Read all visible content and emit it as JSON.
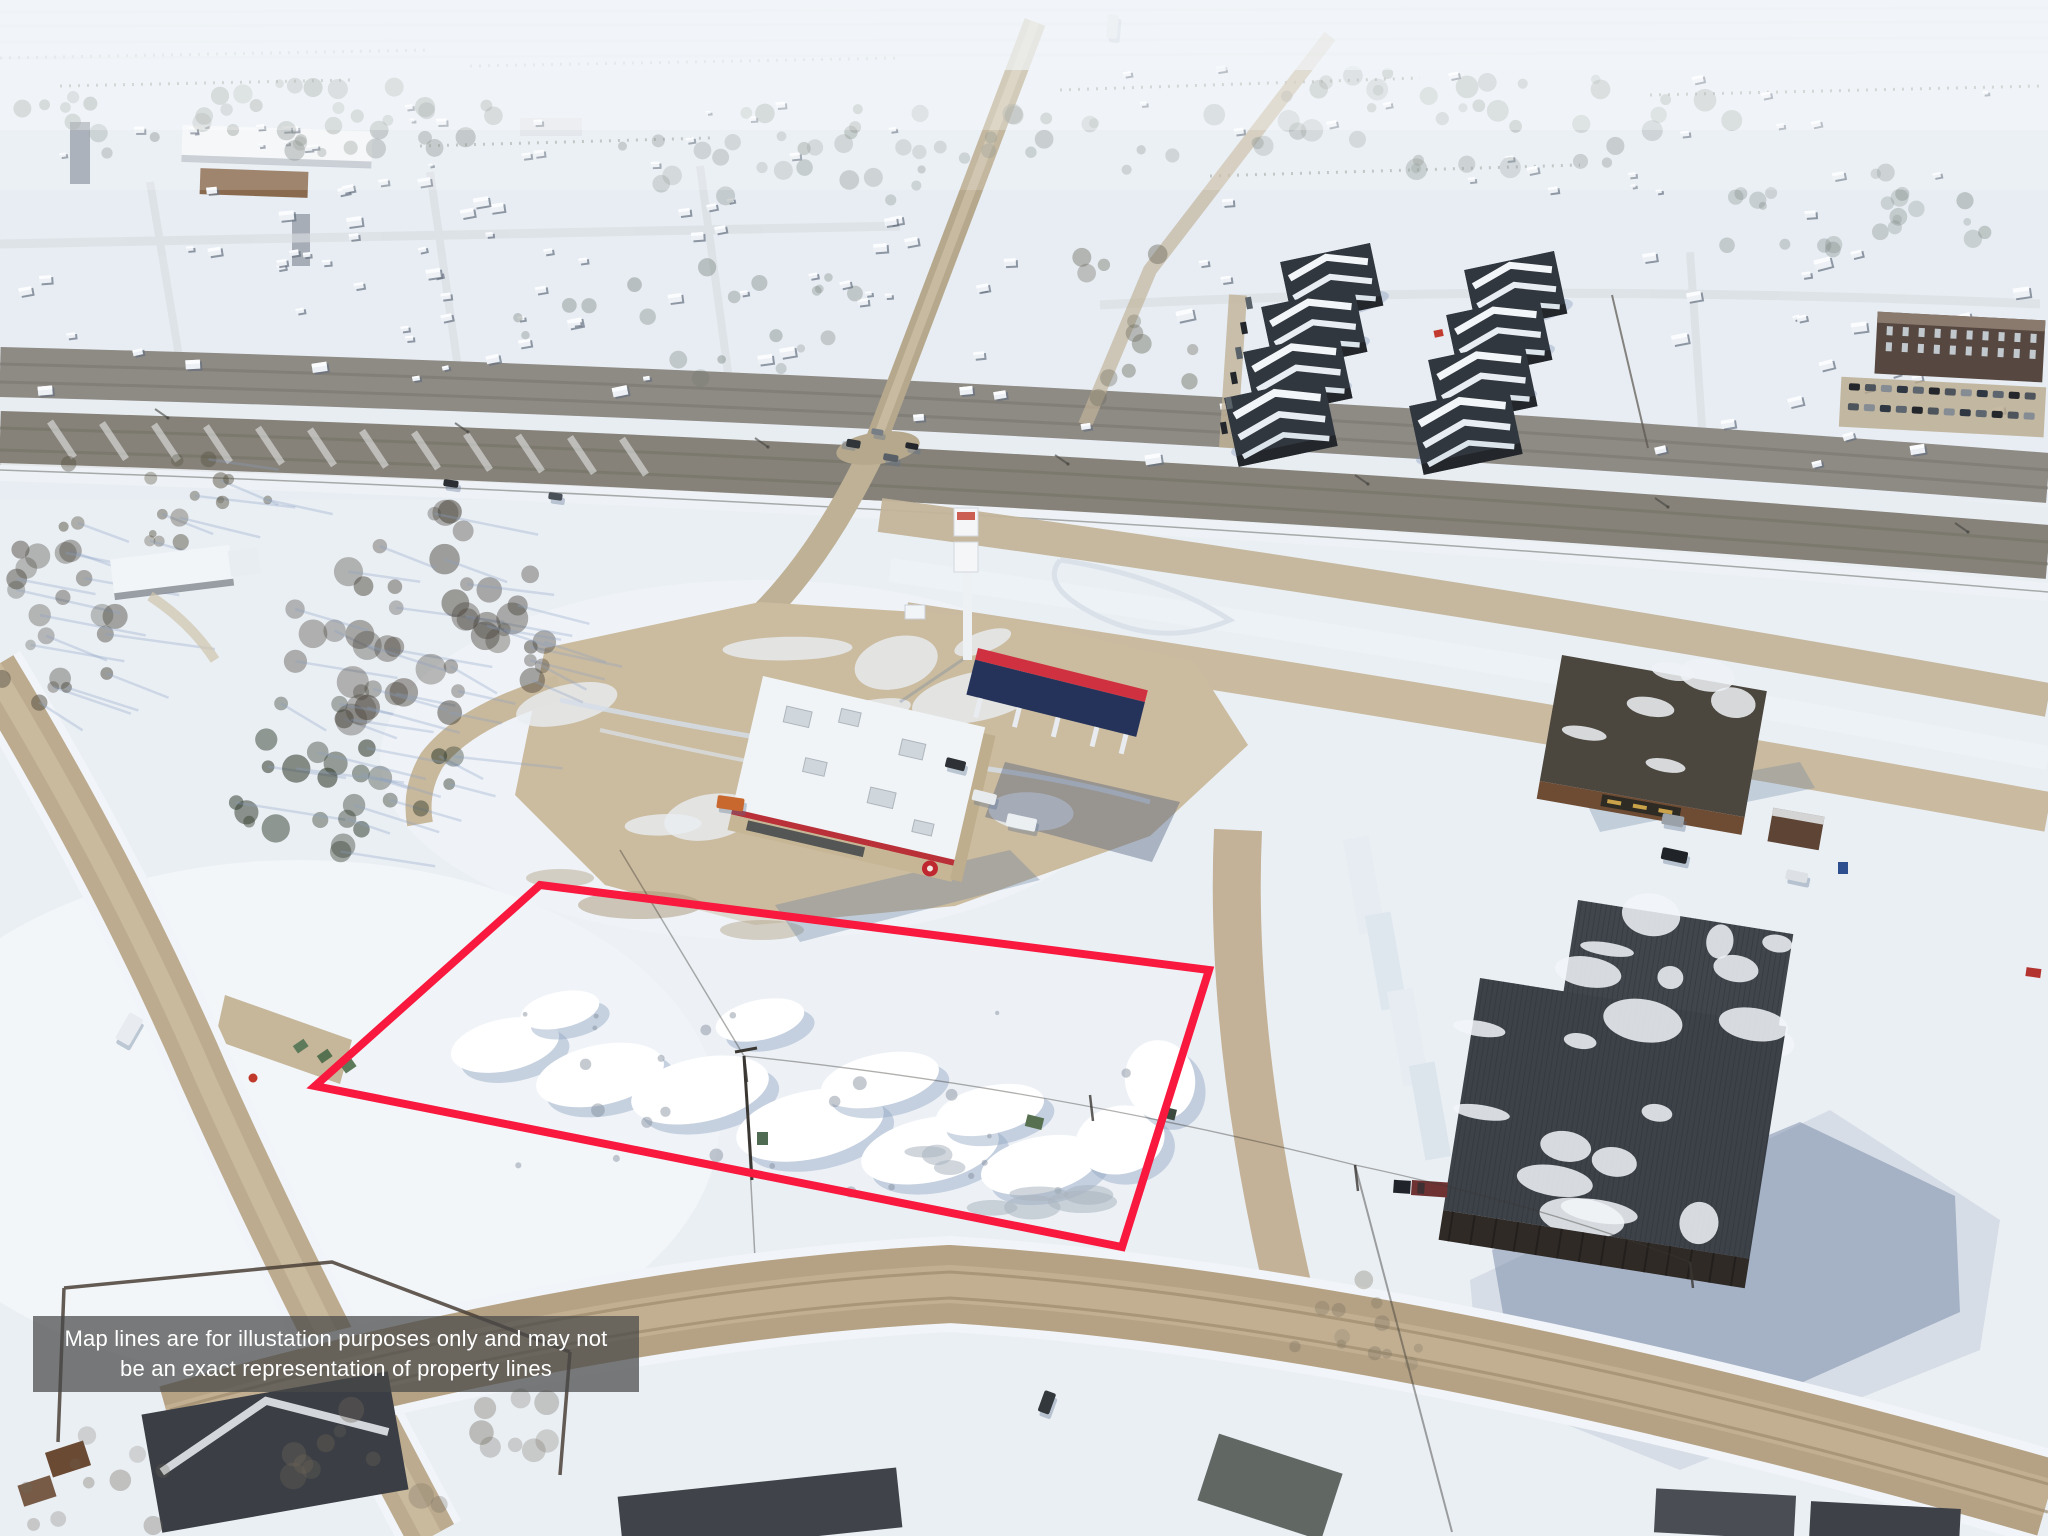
{
  "overlay": {
    "disclaimer_line1": "Map lines are for illustation purposes only and may not",
    "disclaimer_line2": "be an exact representation of property lines",
    "background_color": "rgba(72,72,72,0.72)",
    "text_color": "#ffffff"
  },
  "property_outline": {
    "color": "#F9183E",
    "stroke_width": "8",
    "points": "540,885 1209,970 1122,1247 315,1086"
  },
  "scene": {
    "description": "Aerial winter drone photo: snow-covered vacant commercial lot outlined in red beside a highway intersection, gas station with fuel canopy, commercial buildings, apartment blocks and a residential subdivision under snow"
  }
}
